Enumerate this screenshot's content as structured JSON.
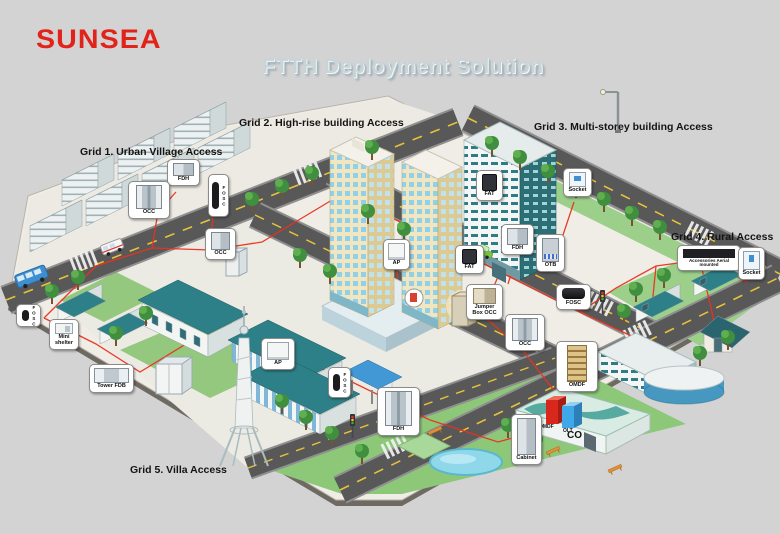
{
  "brand": {
    "logo_text": "SUNSEA",
    "logo_color": "#e2231a"
  },
  "title": {
    "text": "FTTH Deployment Solution"
  },
  "grid_labels": [
    {
      "label": "Grid 1. Urban Village Access"
    },
    {
      "label": "Grid 2. High-rise building Access"
    },
    {
      "label": "Grid 3. Multi-storey building Access"
    },
    {
      "label": "Grid 4. Rural Access"
    },
    {
      "label": "Grid 5. Villa Access"
    }
  ],
  "central_office": {
    "building_label": "CO",
    "omdf_label": "OMDF",
    "olt_label": "OLT"
  },
  "callouts": [
    {
      "id": "fdh-urban-village",
      "label": "FDH"
    },
    {
      "id": "fosc-urban-village",
      "label": "FOSC"
    },
    {
      "id": "occ-urban-village-upper",
      "label": "OCC"
    },
    {
      "id": "occ-urban-village-lower",
      "label": "OCC"
    },
    {
      "id": "ap-high-rise",
      "label": "AP"
    },
    {
      "id": "fat-high-rise",
      "label": "FAT"
    },
    {
      "id": "jumper-box-occ",
      "label": "Jumper Box OCC"
    },
    {
      "id": "fat-multi-storey",
      "label": "FAT"
    },
    {
      "id": "socket-multi-storey",
      "label": "Socket"
    },
    {
      "id": "fdh-multi-storey",
      "label": "FDH"
    },
    {
      "id": "otb-multi-storey",
      "label": "OTB"
    },
    {
      "id": "accessories-aerial-mounted",
      "label": "Accessories Aerial mounted"
    },
    {
      "id": "socket-rural",
      "label": "Socket"
    },
    {
      "id": "fosc-road",
      "label": "FOSC"
    },
    {
      "id": "occ-road",
      "label": "OCC"
    },
    {
      "id": "omdf-central-office",
      "label": "OMDF"
    },
    {
      "id": "cabinet-central-office",
      "label": "Cabinet"
    },
    {
      "id": "fdh-villa",
      "label": "FDH"
    },
    {
      "id": "fosc-left",
      "label": "FOSC"
    },
    {
      "id": "mini-shelter",
      "label": "Mini shelter"
    },
    {
      "id": "tower-fdb",
      "label": "Tower FDB"
    },
    {
      "id": "ap-villa",
      "label": "AP"
    },
    {
      "id": "fosc-villa",
      "label": "FOSC"
    }
  ],
  "colors": {
    "background": "#d3d3d4",
    "logo_red": "#e2231a",
    "title_text": "#c9d4d8",
    "fiber_route_red": "#e8331f",
    "roof_teal": "#2e8088",
    "road_asphalt": "#585858",
    "road_centerline_yellow": "#e6c23c",
    "lawn_green": "#8cc878",
    "highrise_cream": "#f1e6c0",
    "pond_blue": "#8fd8ea"
  }
}
